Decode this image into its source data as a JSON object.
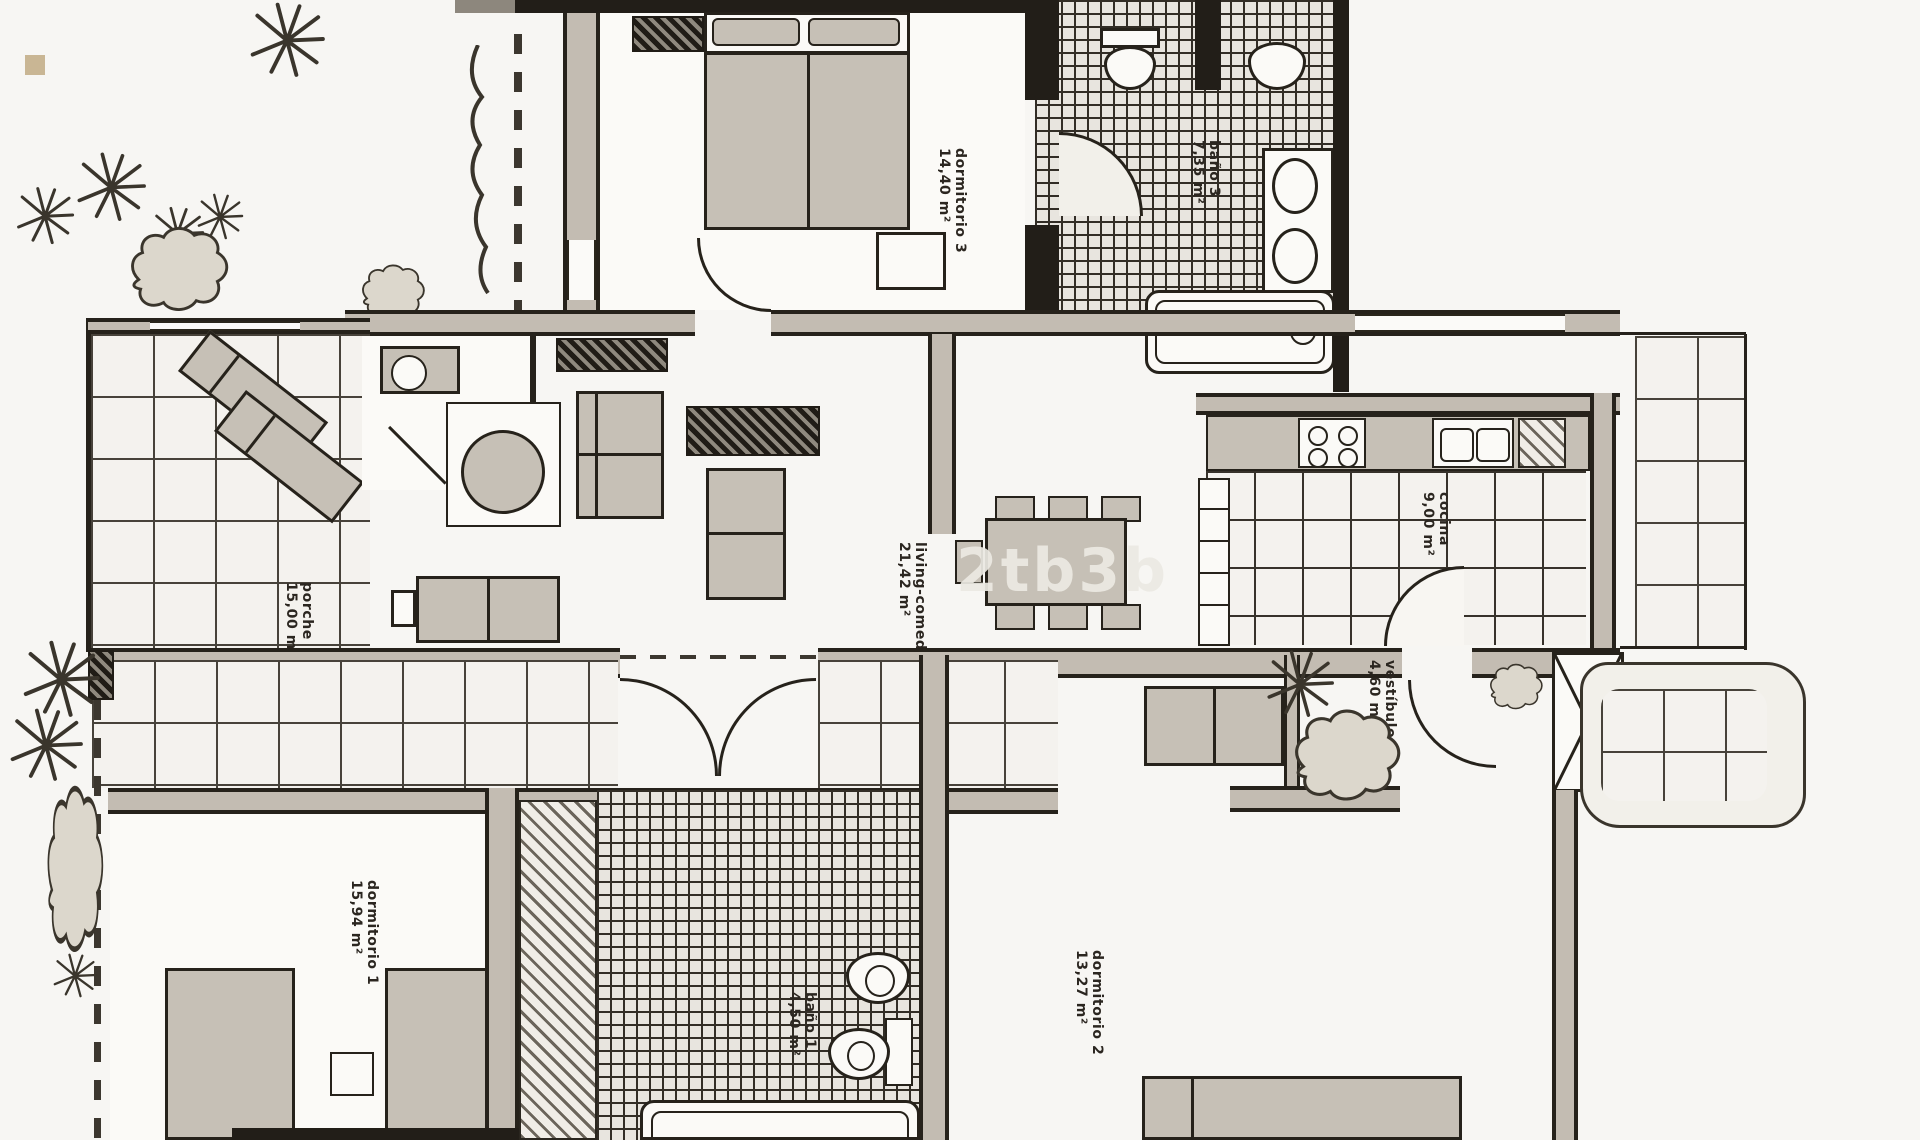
{
  "page": {
    "background": "#f7f6f3",
    "swatch_color": "#c9b694",
    "watermark": "2tb3b"
  },
  "plan": {
    "type": "apartment floor plan (scanned, black and white)",
    "rooms": [
      {
        "name": "dormitorio 3",
        "area": "14,40 m²"
      },
      {
        "name": "baño 3",
        "area": "7,35 m²"
      },
      {
        "name": "living-comedor",
        "area": "21,42 m²"
      },
      {
        "name": "cocina",
        "area": "9,00 m²"
      },
      {
        "name": "vestíbulo",
        "area": "4,60 m²"
      },
      {
        "name": "porche",
        "area": "15,00 m²"
      },
      {
        "name": "dormitorio 1",
        "area": "15,94 m²"
      },
      {
        "name": "baño 1",
        "area": "4,50 m²"
      },
      {
        "name": "dormitorio 2",
        "area": "13,27 m²"
      }
    ],
    "colors": {
      "wall_fill": "#c3bcb2",
      "line": "#26221b",
      "furniture": "#c6c0b6",
      "tile_bg": "#f4f2ee",
      "bath_tile_bg": "#e8e5df"
    }
  }
}
